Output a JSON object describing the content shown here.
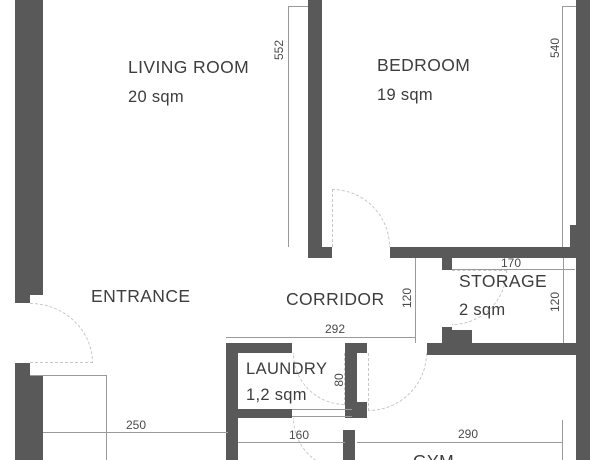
{
  "plan_title": "apartment-floor-plan",
  "colors": {
    "wall": "#595959",
    "dimension_line": "#9a9a9a",
    "door_arc": "#c6c6c6",
    "room_text": "#3d3d3d",
    "dimension_text": "#4a4a4a",
    "background": "#ffffff"
  },
  "rooms": [
    {
      "id": "living-room",
      "name": "LIVING ROOM",
      "area": "20 sqm"
    },
    {
      "id": "bedroom",
      "name": "BEDROOM",
      "area": "19 sqm"
    },
    {
      "id": "entrance",
      "name": "ENTRANCE",
      "area": ""
    },
    {
      "id": "corridor",
      "name": "CORRIDOR",
      "area": ""
    },
    {
      "id": "storage",
      "name": "STORAGE",
      "area": "2 sqm"
    },
    {
      "id": "laundry",
      "name": "LAUNDRY",
      "area": "1,2 sqm"
    },
    {
      "id": "gym",
      "name": "GYM",
      "area": ""
    }
  ],
  "dimensions": [
    {
      "id": "living-room-height",
      "value": "552"
    },
    {
      "id": "bedroom-height",
      "value": "540"
    },
    {
      "id": "corridor-width",
      "value": "292"
    },
    {
      "id": "corridor-depth",
      "value": "120"
    },
    {
      "id": "storage-width",
      "value": "170"
    },
    {
      "id": "storage-depth",
      "value": "120"
    },
    {
      "id": "laundry-depth",
      "value": "80"
    },
    {
      "id": "entrance-width",
      "value": "250"
    },
    {
      "id": "laundry-width",
      "value": "160"
    },
    {
      "id": "gym-width",
      "value": "290"
    }
  ]
}
